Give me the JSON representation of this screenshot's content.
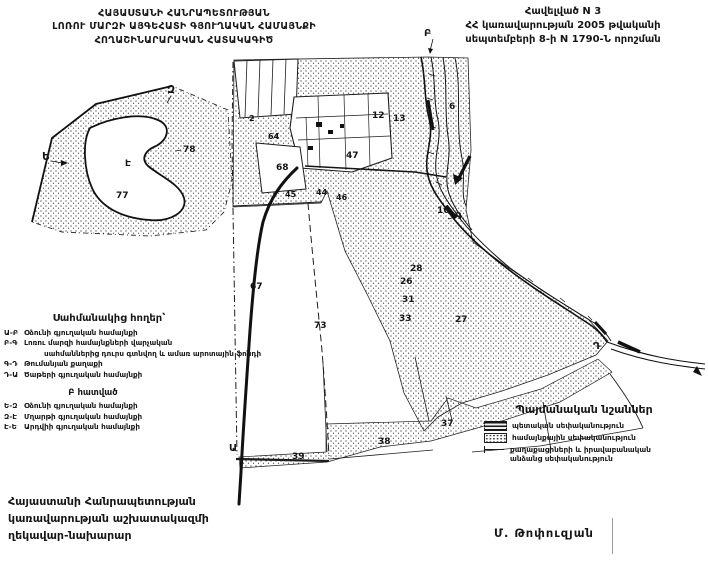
{
  "page": {
    "bg": "#ffffff",
    "ink": "#161616"
  },
  "header": {
    "title_lines": [
      "ՀԱՅԱՍՏԱՆԻ ՀԱՆՐԱՊԵՏՈՒԹՅԱՆ",
      "ԼՈՌՈՒ ՄԱՐԶԻ ԱՅԳԵՀԱՏԻ ԳՅՈՒՂԱԿԱՆ ՀԱՄԱՅՆՔԻ",
      "ՀՈՂԱՇԻՆԱՐԱՐԱԿԱՆ ՀԱՏԱԿԱԳԻԾ"
    ],
    "appendix_lines": [
      "Հավելված N 3",
      "ՀՀ կառավարության 2005 թվականի",
      "սեպտեմբերի 8-ի  N 1790-Ն որոշման"
    ]
  },
  "adjacent_lands": {
    "title": "Սահմանակից հողեր՝",
    "items": [
      {
        "code": "Ա-Բ",
        "text": "Օձունի գյուղական համայնքի",
        "indent": false
      },
      {
        "code": "Բ-Գ",
        "text": "Լոռու մարզի համայնքների վարչական",
        "indent": false
      },
      {
        "code": "",
        "text": "սահմաններից դուրս գտնվող և ամառ արոտային ֆոնդի",
        "indent": true
      },
      {
        "code": "Գ-Դ",
        "text": "Թումանյան քաղաքի",
        "indent": false
      },
      {
        "code": "Դ-Ա",
        "text": "Ծաթերի գյուղական համայնքի",
        "indent": false
      }
    ],
    "section_b_title": "Բ հատված",
    "section_b_items": [
      {
        "code": "Ե-Զ",
        "text": "Օձունի գյուղական համայնքի",
        "indent": false
      },
      {
        "code": "Զ-Է",
        "text": "Մղարթի գյուղական համայնքի",
        "indent": false
      },
      {
        "code": "Է-Ե",
        "text": "Արդվիի գյուղական համայնքի",
        "indent": false
      }
    ]
  },
  "map_legend": {
    "title": "Պայմանական նշաններ",
    "items": [
      {
        "swatch": "state-hatched-box",
        "label": "պետական սեփականություն"
      },
      {
        "swatch": "community-dotted-box",
        "label": "համայնքային սեփականություն"
      },
      {
        "swatch": "private-line",
        "label": "քաղաքացիների և իրավաբանական անձանց սեփականություն"
      }
    ]
  },
  "signature": {
    "lines": [
      "Հայաստանի Հանրապետության",
      "կառավարության աշխատակազմի",
      "ղեկավար-նախարար"
    ],
    "name": "Մ. Թոփուզյան"
  },
  "map": {
    "boundary_points_main": [
      "Ա",
      "Բ",
      "Գ",
      "Դ"
    ],
    "boundary_points_inset": [
      "Ե",
      "Զ",
      "Է"
    ],
    "labels": [
      {
        "t": "Բ",
        "x": 424,
        "y": 36,
        "s": 10,
        "n": "boundary-point-B"
      },
      {
        "t": "6",
        "x": 449,
        "y": 109,
        "s": 9,
        "n": "parcel-number"
      },
      {
        "t": "12",
        "x": 372,
        "y": 118,
        "s": 9,
        "n": "parcel-number"
      },
      {
        "t": "13",
        "x": 393,
        "y": 121,
        "s": 9,
        "n": "parcel-number"
      },
      {
        "t": "2",
        "x": 249,
        "y": 121,
        "s": 8,
        "n": "parcel-number"
      },
      {
        "t": "64",
        "x": 268,
        "y": 139,
        "s": 8,
        "n": "parcel-number"
      },
      {
        "t": "68",
        "x": 276,
        "y": 170,
        "s": 9,
        "n": "parcel-number"
      },
      {
        "t": "47",
        "x": 346,
        "y": 158,
        "s": 9,
        "n": "parcel-number"
      },
      {
        "t": "45",
        "x": 285,
        "y": 197,
        "s": 8,
        "n": "parcel-number"
      },
      {
        "t": "44",
        "x": 316,
        "y": 195,
        "s": 8,
        "n": "parcel-number"
      },
      {
        "t": "46",
        "x": 336,
        "y": 200,
        "s": 8,
        "n": "parcel-number"
      },
      {
        "t": "16",
        "x": 437,
        "y": 213,
        "s": 9,
        "n": "parcel-number"
      },
      {
        "t": "Գ",
        "x": 455,
        "y": 219,
        "s": 10,
        "n": "boundary-point-G"
      },
      {
        "t": "28",
        "x": 410,
        "y": 271,
        "s": 9,
        "n": "parcel-number"
      },
      {
        "t": "26",
        "x": 400,
        "y": 284,
        "s": 9,
        "n": "parcel-number"
      },
      {
        "t": "31",
        "x": 402,
        "y": 302,
        "s": 9,
        "n": "parcel-number"
      },
      {
        "t": "33",
        "x": 399,
        "y": 321,
        "s": 9,
        "n": "parcel-number"
      },
      {
        "t": "27",
        "x": 455,
        "y": 322,
        "s": 9,
        "n": "parcel-number"
      },
      {
        "t": "67",
        "x": 250,
        "y": 289,
        "s": 9,
        "n": "parcel-number"
      },
      {
        "t": "73",
        "x": 314,
        "y": 328,
        "s": 9,
        "n": "parcel-number"
      },
      {
        "t": "Դ",
        "x": 593,
        "y": 349,
        "s": 10,
        "n": "boundary-point-D"
      },
      {
        "t": "Ա",
        "x": 229,
        "y": 451,
        "s": 10,
        "n": "boundary-point-A"
      },
      {
        "t": "39",
        "x": 292,
        "y": 459,
        "s": 9,
        "n": "parcel-number"
      },
      {
        "t": "38",
        "x": 378,
        "y": 444,
        "s": 9,
        "n": "parcel-number"
      },
      {
        "t": "37",
        "x": 441,
        "y": 426,
        "s": 9,
        "n": "parcel-number"
      }
    ],
    "inset_labels": [
      {
        "t": "Զ",
        "x": 167,
        "y": 93,
        "s": 11,
        "n": "boundary-point-Z"
      },
      {
        "t": "Ե",
        "x": 42,
        "y": 160,
        "s": 11,
        "n": "boundary-point-E"
      },
      {
        "t": "78",
        "x": 183,
        "y": 152,
        "s": 9,
        "n": "parcel-number"
      },
      {
        "t": "Է",
        "x": 125,
        "y": 166,
        "s": 9,
        "n": "boundary-point-Ee"
      },
      {
        "t": "77",
        "x": 116,
        "y": 198,
        "s": 9,
        "n": "parcel-number"
      }
    ]
  }
}
